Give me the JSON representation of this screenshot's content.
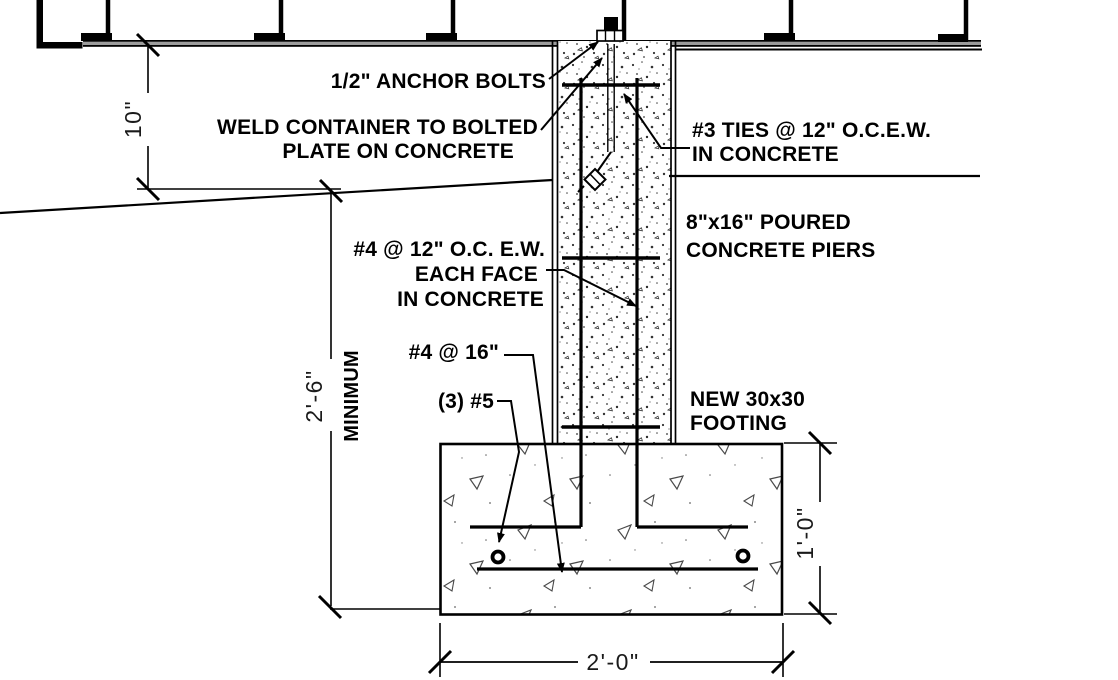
{
  "drawing": {
    "type": "foundation-section-detail",
    "callouts": {
      "anchor_bolts": "1/2\" ANCHOR BOLTS",
      "weld_note_line1": "WELD CONTAINER TO BOLTED",
      "weld_note_line2": "PLATE ON CONCRETE",
      "ties_note_line1": "#3 TIES @ 12\" O.C.E.W.",
      "ties_note_line2": "IN CONCRETE",
      "pier_note_line1": "8\"x16\" POURED",
      "pier_note_line2": "CONCRETE PIERS",
      "reinf_note_line1": "#4 @ 12\" O.C. E.W.",
      "reinf_note_line2": "EACH FACE",
      "reinf_note_line3": "IN CONCRETE",
      "footing_transverse_bar_note": "#4 @ 16\"",
      "footing_long_bars_note": "(3) #5",
      "footing_note_line1": "NEW 30x30",
      "footing_note_line2": "FOOTING"
    },
    "dimensions": {
      "pier_exposed_height": "10\"",
      "embed_depth": "2'-6\"",
      "embed_depth_qualifier": "MINIMUM",
      "footing_depth": "1'-0\"",
      "footing_width": "2'-0\""
    },
    "colors": {
      "line": "#000000",
      "floor_band": "#9c9c9c",
      "background": "#ffffff"
    }
  }
}
